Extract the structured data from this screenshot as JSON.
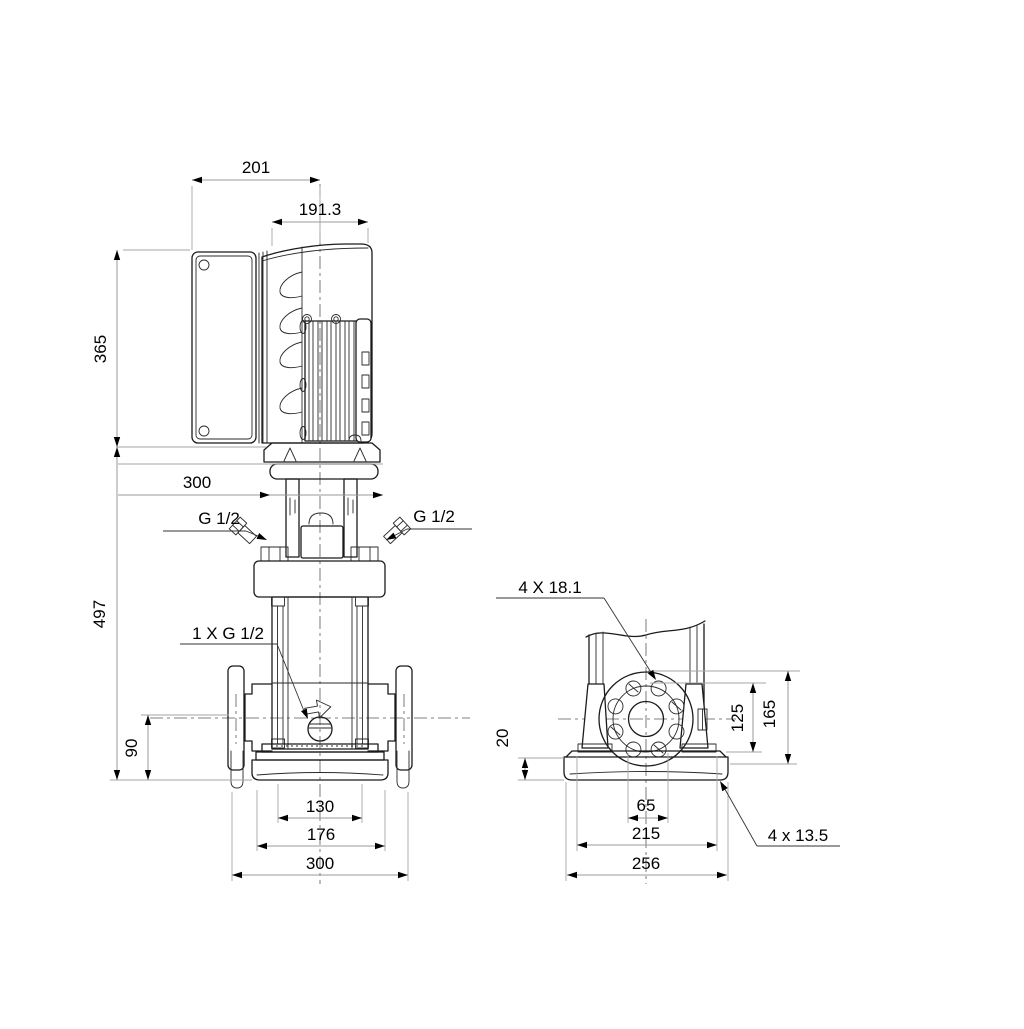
{
  "page": {
    "background": "#ffffff",
    "line_color": "#1b1b1b",
    "dim_line_color": "#9a9a9a",
    "description": "Dimensional outline drawing of a vertical multistage centrifugal pump, front view and side (flange) view"
  },
  "views": {
    "front": {
      "dims": {
        "control_box_width": "201",
        "motor_length": "191.3",
        "motor_height": "365",
        "pump_height": "497",
        "motor_flange_width": "300",
        "vent_plug_left": "G 1/2",
        "vent_plug_right": "G 1/2",
        "drain_plug": "1 X G 1/2",
        "port_center_height": "90",
        "base_inner_width": "130",
        "base_plate_width": "176",
        "base_overall_width": "300"
      }
    },
    "side": {
      "dims": {
        "flange_holes": "4 X 18.1",
        "flange_center_to_base": "125",
        "flange_top_to_base": "165",
        "base_plate_thickness": "20",
        "hole_slot_spacing": "65",
        "bolt_hole_spacing": "215",
        "base_depth": "256",
        "foundation_holes": "4 x 13.5"
      }
    }
  }
}
